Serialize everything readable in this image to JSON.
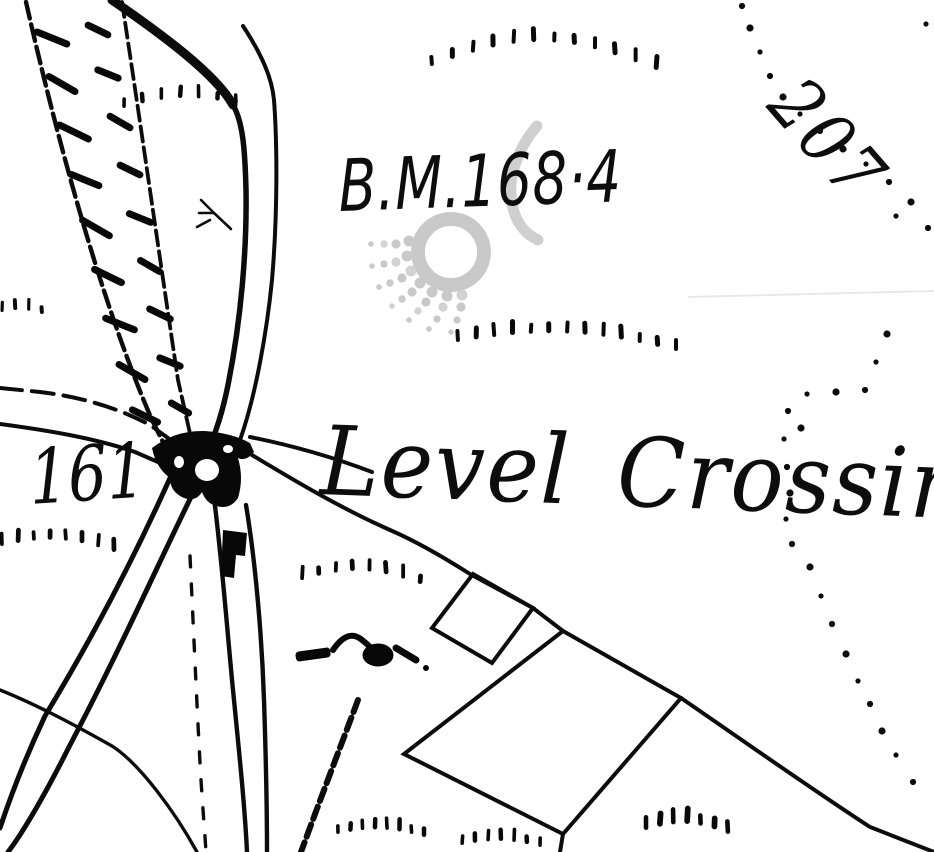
{
  "map": {
    "title": "Historic Ordnance Survey map extract - railway level crossing",
    "labels": {
      "benchmark": "B.M.168·4",
      "level_crossing": "Level Crossing",
      "spot_height_left": "161",
      "spot_height_right": "207"
    },
    "watermark": {
      "name": "osi watermark",
      "color": "#c6c6c6"
    },
    "colors": {
      "background": "#ffffff",
      "ink": "#111111",
      "watermark": "#c6c6c6",
      "scan_artifact": "#e4e4e4"
    }
  }
}
